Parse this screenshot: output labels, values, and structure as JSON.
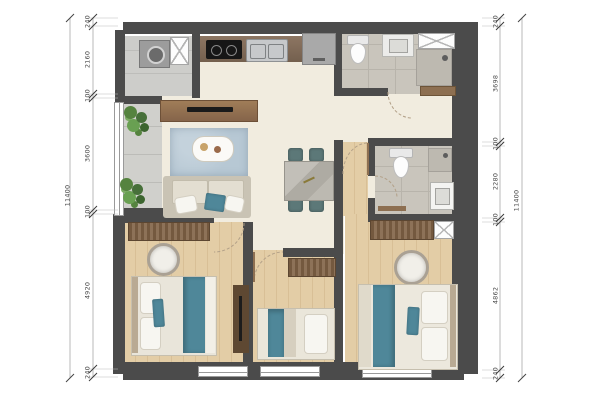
{
  "plan": {
    "title": "apartment-floor-plan",
    "dimensions": {
      "left": {
        "total": "11400",
        "segments": [
          "240",
          "2160",
          "100",
          "3600",
          "100",
          "4920",
          "240"
        ]
      },
      "right": {
        "total": "11400",
        "segments": [
          "240",
          "3698",
          "100",
          "2280",
          "100",
          "4862",
          "240"
        ]
      }
    }
  },
  "colors": {
    "wall": "#4b4b4b",
    "floor": "#f1ecdf",
    "bathTile": "#c9c5bc",
    "utilityTile": "#cdcdca",
    "balconyStone": "#d0d0cc",
    "woodFloor": "#e3cda6",
    "woodFurn": "#8d6f51",
    "teal": "#4f8799",
    "chairTeal": "#5c7878",
    "rug": "#b7c8d4",
    "dimText": "#4a4a4a"
  }
}
